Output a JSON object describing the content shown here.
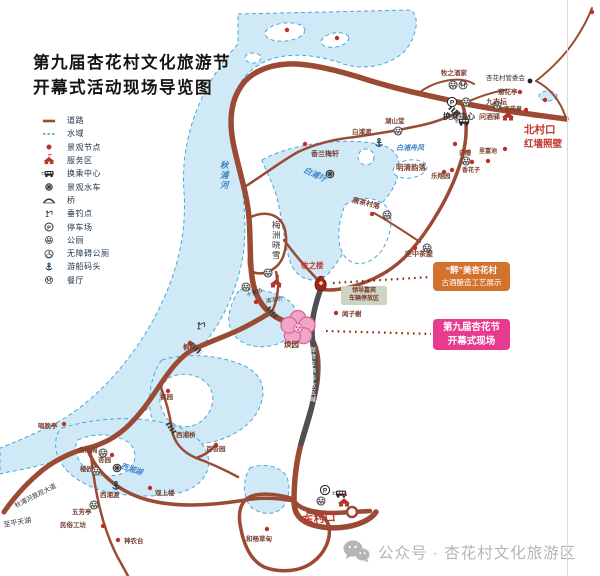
{
  "title": {
    "line1": "第九届杏花村文化旅游节",
    "line2": "开幕式活动现场导览图"
  },
  "legend": {
    "items": [
      {
        "icon": "road",
        "label": "道路"
      },
      {
        "icon": "water",
        "label": "水域"
      },
      {
        "icon": "node",
        "label": "景观节点"
      },
      {
        "icon": "service",
        "label": "服务区"
      },
      {
        "icon": "transfer",
        "label": "换乘中心"
      },
      {
        "icon": "waterwheel",
        "label": "景观水车"
      },
      {
        "icon": "bridge",
        "label": "桥"
      },
      {
        "icon": "fishing",
        "label": "垂钓点"
      },
      {
        "icon": "parking",
        "label": "停车场"
      },
      {
        "icon": "toilet",
        "label": "公厕"
      },
      {
        "icon": "accessible",
        "label": "无障碍公厕"
      },
      {
        "icon": "dock",
        "label": "游船码头"
      },
      {
        "icon": "restaurant",
        "label": "餐厅"
      }
    ]
  },
  "callouts": {
    "brewing_line1": "“醉”美杏花村",
    "brewing_line2": "古酒酿造工艺展示",
    "opening_line1": "第九届杏花节",
    "opening_line2": "开幕式现场"
  },
  "boxes": {
    "vip_line1": "领导嘉宾",
    "vip_line2": "车辆停放区"
  },
  "footer": {
    "wechat": "公众号 · 杏花村文化旅游区"
  },
  "icons": {
    "parking_glyph": "P"
  },
  "colors": {
    "road": "#9b4a33",
    "dark_road": "#4f4f4f",
    "water_fill": "#cfe9f6",
    "water_line": "#49a7d6",
    "accent_red": "#c2342a",
    "callout_orange": "#d2722f",
    "callout_pink": "#e83a8e",
    "flower_pink": "#f1a6c6"
  },
  "map": {
    "pois": [
      {
        "t": "牧之酒家",
        "x": 441,
        "y": 75,
        "c": "poi",
        "s": 6.5
      },
      {
        "t": "杏花村管委会",
        "x": 486,
        "y": 80,
        "c": "black",
        "s": 6.5
      },
      {
        "t": "憩花亭",
        "x": 498,
        "y": 94,
        "c": "poi",
        "s": 6.5
      },
      {
        "t": "九吉坛",
        "x": 486,
        "y": 104,
        "c": "poi",
        "s": 7
      },
      {
        "t": "杏花泉",
        "x": 504,
        "y": 111,
        "c": "poi",
        "s": 6
      },
      {
        "t": "换乘中心",
        "x": 443,
        "y": 119,
        "c": "black",
        "s": 8,
        "b": 1
      },
      {
        "t": "问酒驿",
        "x": 479,
        "y": 119,
        "c": "poi",
        "s": 7
      },
      {
        "t": "北村口",
        "x": 524,
        "y": 133,
        "c": "red",
        "s": 10.5,
        "b": 1
      },
      {
        "t": "红墙照壁",
        "x": 524,
        "y": 147,
        "c": "red",
        "s": 9.5,
        "b": 1
      },
      {
        "t": "湖山堂",
        "x": 385,
        "y": 123,
        "c": "poi",
        "s": 6.5
      },
      {
        "t": "白浦渡",
        "x": 352,
        "y": 134,
        "c": "poi",
        "s": 6.5
      },
      {
        "t": "白浦舟风",
        "x": 396,
        "y": 150,
        "c": "water",
        "s": 7
      },
      {
        "t": "香兰梅轩",
        "x": 311,
        "y": 156,
        "c": "poi",
        "s": 7
      },
      {
        "t": "白醴",
        "x": 459,
        "y": 155,
        "c": "poi",
        "s": 6
      },
      {
        "t": "里富池",
        "x": 479,
        "y": 153,
        "c": "poi",
        "s": 6
      },
      {
        "t": "香花子",
        "x": 462,
        "y": 172,
        "c": "poi",
        "s": 6
      },
      {
        "t": "乐翔园",
        "x": 431,
        "y": 178,
        "c": "poi",
        "s": 6.5
      },
      {
        "t": "明清韵落",
        "x": 396,
        "y": 170,
        "c": "poi",
        "s": 7.5
      },
      {
        "t": "唐茶村落",
        "x": 352,
        "y": 202,
        "c": "poi",
        "s": 7,
        "r": 14
      },
      {
        "t": "白浦圩",
        "x": 303,
        "y": 172,
        "c": "water",
        "s": 8,
        "r": 24
      },
      {
        "t": "梅洲晓雪",
        "x": 272,
        "y": 228,
        "c": "black",
        "s": 8.5,
        "v": 1
      },
      {
        "t": "空中茶屋",
        "x": 405,
        "y": 256,
        "c": "poi",
        "s": 7
      },
      {
        "t": "牧之楼",
        "x": 301,
        "y": 268,
        "c": "red",
        "s": 7.5,
        "b": 1
      },
      {
        "t": "闻子榭",
        "x": 342,
        "y": 316,
        "c": "poi",
        "s": 6.5
      },
      {
        "t": "焕园",
        "x": 284,
        "y": 347,
        "c": "poi",
        "s": 7.5
      },
      {
        "t": "十里桥",
        "x": 247,
        "y": 297,
        "c": "black",
        "s": 5.5,
        "r": -18
      },
      {
        "t": "清凉桥",
        "x": 266,
        "y": 303,
        "c": "black",
        "s": 5.5,
        "r": -10
      },
      {
        "t": "枫桥",
        "x": 183,
        "y": 349,
        "c": "poi",
        "s": 6.5
      },
      {
        "t": "枫园",
        "x": 160,
        "y": 399,
        "c": "poi",
        "s": 6.5
      },
      {
        "t": "唱晚亭",
        "x": 38,
        "y": 428,
        "c": "poi",
        "s": 6.5
      },
      {
        "t": "西湘桥",
        "x": 176,
        "y": 437,
        "c": "poi",
        "s": 6.5
      },
      {
        "t": "百杏园",
        "x": 206,
        "y": 451,
        "c": "poi",
        "s": 6.5
      },
      {
        "t": "会仙阁",
        "x": 78,
        "y": 452,
        "c": "poi",
        "s": 6.5
      },
      {
        "t": "杏园",
        "x": 98,
        "y": 462,
        "c": "poi",
        "s": 6.5
      },
      {
        "t": "楼园",
        "x": 80,
        "y": 471,
        "c": "poi",
        "s": 6.5
      },
      {
        "t": "西湘渡",
        "x": 100,
        "y": 497,
        "c": "poi",
        "s": 6.5
      },
      {
        "t": "西湘湖",
        "x": 120,
        "y": 468,
        "c": "water",
        "s": 7.5,
        "r": 18
      },
      {
        "t": "观上楼",
        "x": 155,
        "y": 495,
        "c": "poi",
        "s": 6.5
      },
      {
        "t": "五芳亭",
        "x": 72,
        "y": 514,
        "c": "poi",
        "s": 6.5
      },
      {
        "t": "民俗工坊",
        "x": 60,
        "y": 527,
        "c": "poi",
        "s": 6.5
      },
      {
        "t": "神农台",
        "x": 124,
        "y": 543,
        "c": "poi",
        "s": 6.5
      },
      {
        "t": "东村口",
        "x": 303,
        "y": 524,
        "c": "red",
        "s": 11,
        "b": 1,
        "r": -6
      },
      {
        "t": "和畅草甸",
        "x": 246,
        "y": 541,
        "c": "poi",
        "s": 6.5
      },
      {
        "t": "秋浦河",
        "x": 220,
        "y": 168,
        "c": "water",
        "s": 8.5,
        "v": 1
      },
      {
        "t": "秋浦河景观大道",
        "x": 16,
        "y": 508,
        "c": "black",
        "s": 6.5,
        "r": -27
      },
      {
        "t": "至平天湖",
        "x": 4,
        "y": 527,
        "c": "black",
        "s": 7,
        "r": -10
      },
      {
        "t": "保障车辆停放区域",
        "x": 310,
        "y": 352,
        "c": "white",
        "s": 6,
        "v": 1
      }
    ],
    "markers": [
      {
        "k": "toilet",
        "x": 453,
        "y": 85
      },
      {
        "k": "restaurant",
        "x": 463,
        "y": 85
      },
      {
        "k": "dot-black",
        "x": 530,
        "y": 81
      },
      {
        "k": "dot",
        "x": 520,
        "y": 92
      },
      {
        "k": "dot",
        "x": 526,
        "y": 110
      },
      {
        "k": "toilet",
        "x": 497,
        "y": 105
      },
      {
        "k": "parking",
        "x": 452,
        "y": 102
      },
      {
        "k": "toilet",
        "x": 466,
        "y": 102
      },
      {
        "k": "bus",
        "x": 464,
        "y": 122
      },
      {
        "k": "dot",
        "x": 545,
        "y": 100
      },
      {
        "k": "dot",
        "x": 505,
        "y": 149
      },
      {
        "k": "dot",
        "x": 455,
        "y": 144
      },
      {
        "k": "dot",
        "x": 592,
        "y": 12
      },
      {
        "k": "building",
        "x": 508,
        "y": 117
      },
      {
        "k": "toilet",
        "x": 398,
        "y": 131
      },
      {
        "k": "anchor",
        "x": 379,
        "y": 143
      },
      {
        "k": "dot",
        "x": 305,
        "y": 144
      },
      {
        "k": "toilet",
        "x": 466,
        "y": 161
      },
      {
        "k": "dot",
        "x": 472,
        "y": 162
      },
      {
        "k": "dot",
        "x": 488,
        "y": 161
      },
      {
        "k": "dot",
        "x": 452,
        "y": 170
      },
      {
        "k": "dot",
        "x": 444,
        "y": 172
      },
      {
        "k": "dot",
        "x": 372,
        "y": 214
      },
      {
        "k": "toilet",
        "x": 387,
        "y": 215
      },
      {
        "k": "waterwheel",
        "x": 330,
        "y": 174
      },
      {
        "k": "dot",
        "x": 415,
        "y": 248
      },
      {
        "k": "toilet",
        "x": 427,
        "y": 248
      },
      {
        "k": "jar",
        "x": 321,
        "y": 284
      },
      {
        "k": "dot",
        "x": 336,
        "y": 313
      },
      {
        "k": "flower",
        "x": 298,
        "y": 328
      },
      {
        "k": "building",
        "x": 276,
        "y": 284
      },
      {
        "k": "toilet",
        "x": 268,
        "y": 273
      },
      {
        "k": "toilet",
        "x": 246,
        "y": 287
      },
      {
        "k": "dot",
        "x": 256,
        "y": 302
      },
      {
        "k": "fishing",
        "x": 201,
        "y": 326
      },
      {
        "k": "dot",
        "x": 190,
        "y": 343
      },
      {
        "k": "dot",
        "x": 168,
        "y": 391
      },
      {
        "k": "dot",
        "x": 64,
        "y": 424
      },
      {
        "k": "dot",
        "x": 216,
        "y": 445
      },
      {
        "k": "toilet",
        "x": 103,
        "y": 453
      },
      {
        "k": "dot",
        "x": 112,
        "y": 455
      },
      {
        "k": "toilet",
        "x": 96,
        "y": 471
      },
      {
        "k": "waterwheel",
        "x": 117,
        "y": 468
      },
      {
        "k": "anchor",
        "x": 116,
        "y": 486
      },
      {
        "k": "dot",
        "x": 150,
        "y": 488
      },
      {
        "k": "toilet",
        "x": 94,
        "y": 505
      },
      {
        "k": "dot",
        "x": 103,
        "y": 526
      },
      {
        "k": "dot",
        "x": 118,
        "y": 540
      },
      {
        "k": "dot",
        "x": 267,
        "y": 529
      },
      {
        "k": "parking",
        "x": 325,
        "y": 490
      },
      {
        "k": "bus",
        "x": 341,
        "y": 494
      },
      {
        "k": "toilet",
        "x": 321,
        "y": 501
      },
      {
        "k": "building",
        "x": 344,
        "y": 503
      },
      {
        "k": "entrance",
        "x": 352,
        "y": 512
      },
      {
        "k": "dot",
        "x": 287,
        "y": 30
      },
      {
        "k": "dot",
        "x": 337,
        "y": 38
      }
    ]
  }
}
